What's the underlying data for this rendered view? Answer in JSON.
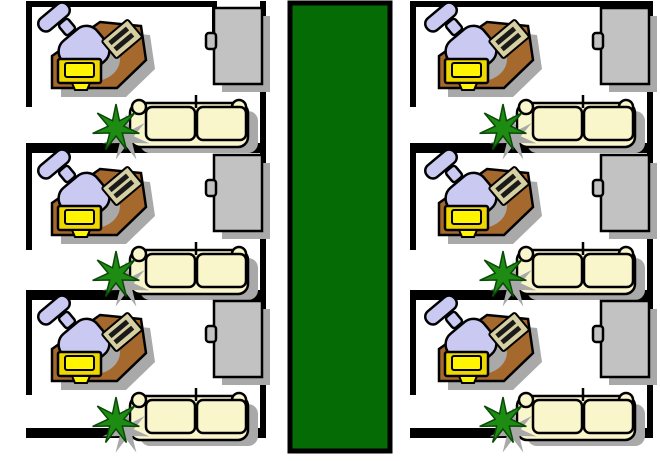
{
  "title": "Office floor plan",
  "colors": {
    "wall": "#000000",
    "room_bg": "#FFFFFF",
    "corridor_green": "#056B05",
    "desk_brown": "#A5682D",
    "chair_lavender": "#C9C9F2",
    "couch_cream": "#FAF6CC",
    "cabinet_gray": "#C2C2C2",
    "monitor_yellow": "#EFD800",
    "monitor_screen_yellow": "#FFF500",
    "keyboard_tan": "#D6CFA2",
    "keyboard_keys": "#1A1A1A",
    "plant_green": "#1E8C12",
    "plant_outline": "#0A4A08",
    "shadow_gray": "#A9A9A9"
  },
  "corridor": {
    "name": "corridor-carpet"
  },
  "offices": [
    {
      "name": "office-left-1",
      "transform": "translate(0,0)"
    },
    {
      "name": "office-left-2",
      "transform": "translate(0,147)"
    },
    {
      "name": "office-left-3",
      "transform": "translate(0,293)"
    },
    {
      "name": "office-right-1",
      "transform": "translate(387,0)"
    },
    {
      "name": "office-right-2",
      "transform": "translate(387,147)"
    },
    {
      "name": "office-right-3",
      "transform": "translate(387,293)"
    }
  ],
  "furniture_items": [
    "filing-cabinet",
    "couch",
    "plant",
    "desk",
    "office-chair",
    "keyboard",
    "computer-monitor"
  ]
}
